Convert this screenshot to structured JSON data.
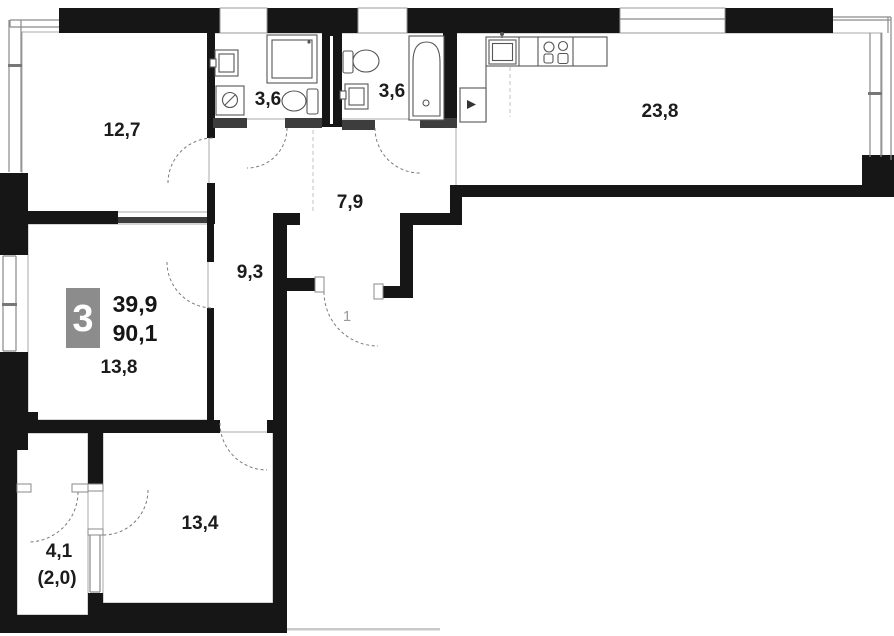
{
  "plan_type": "apartment-floor-plan",
  "badge": {
    "rooms_count": "3",
    "area_top": "39,9",
    "area_bottom": "90,1",
    "badge_bg": "#8c8c8c",
    "badge_text": "#ffffff"
  },
  "rooms": {
    "room1": "12,7",
    "bath1": "3,6",
    "bath2": "3,6",
    "kitchen_living": "23,8",
    "hallway": "7,9",
    "corridor": "9,3",
    "room2": "13,8",
    "room3": "13,4",
    "loggia": "4,1",
    "loggia_reduced": "(2,0)"
  },
  "entrance": {
    "door_number": "1"
  },
  "colors": {
    "wall": "#161616",
    "partition": "#3d3d3d",
    "label_text": "#1c1c1c",
    "muted": "#9a9a9a"
  }
}
